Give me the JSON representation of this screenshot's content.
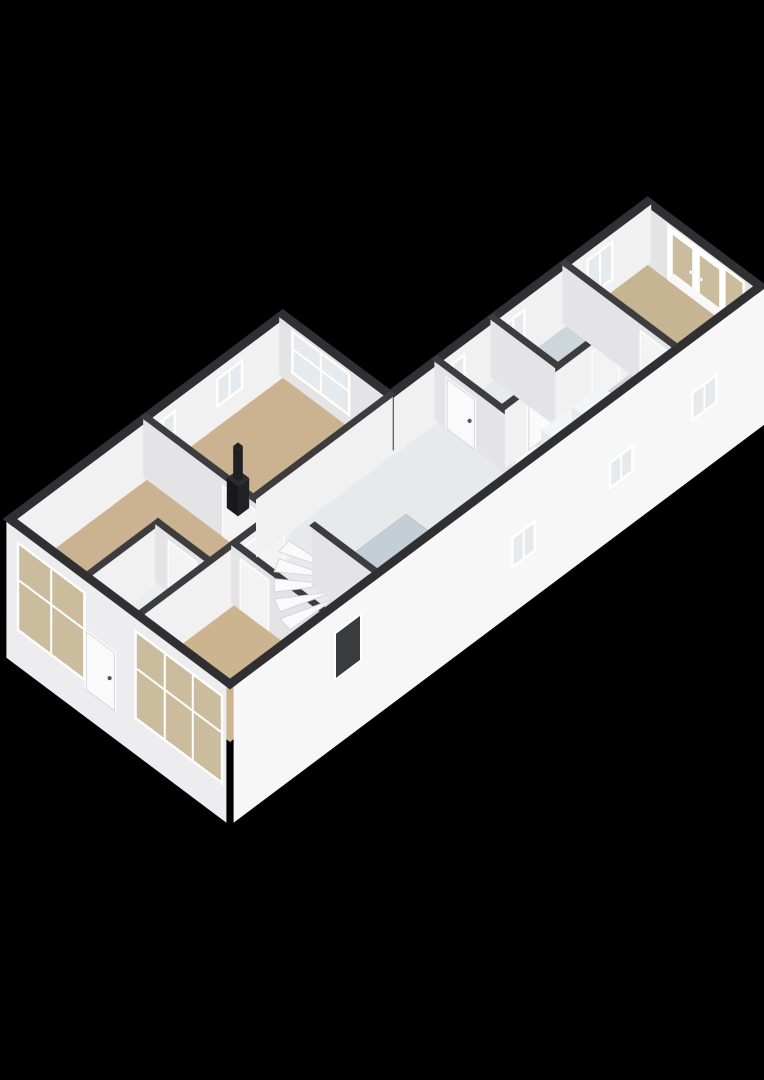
{
  "scene": {
    "width": 764,
    "height": 1080,
    "background": "#000000",
    "view": "isometric-3d-floorplan",
    "origin": [
      10,
      577
    ],
    "unit": {
      "ux": 0.8,
      "uy": -0.6,
      "vx": 0.8,
      "vy": 0.6
    },
    "wall_height": 58,
    "facade_depth": 78,
    "wall_thickness_ext": 9,
    "wall_thickness_int": 7
  },
  "palette": {
    "wall_top_ext": "#303032",
    "wall_top_int": "#3d3d3f",
    "face_se_int": "#f1f1f2",
    "face_sw_int": "#e4e4e6",
    "face_se_ext": "#f7f7f7",
    "face_sw_ext": "#ededef",
    "frame": "#ffffff",
    "glass": "#e6eaec",
    "glass_tan": "#cbbc9e",
    "gap": "#f3f3f4",
    "floor_tan": "#cbb290",
    "floor_tan2": "#ccb490",
    "floor_tan3": "#c6b493",
    "floor_blue": "#c3ced6",
    "floor_blue_light": "#cdd6db",
    "floor_white": "#e8e9ea",
    "floor_white2": "#eceded",
    "tread": "#fafafb",
    "tread_edge": "#d4d4d6",
    "door_leaf": "#fafafb",
    "door_edge": "#d8d8da",
    "door_dark": "#3a3b3d",
    "handle": "#55585b",
    "stove_top": "#2c2c2e",
    "stove_sw": "#19191b",
    "stove_se": "#222224",
    "pipe": "#202022",
    "counter_top": "#f4f4f5",
    "counter_sw": "#e2e3e5",
    "counter_se": "#ebeced",
    "cooktop": "#151618",
    "burner": "#c13336",
    "burner_core": "#7e1f22",
    "appl_top": "#f3f4f5",
    "appl_sw": "#e7e9eb",
    "appl_se": "#dfe1e4",
    "porthole_ring": "#b7bcc0",
    "porthole_glass": "#eef0f2",
    "porthole_core": "#c9cfd3",
    "threshold": "#f8f8f9"
  },
  "floors": [
    {
      "name": "floor-living-room",
      "color": "floor_tan",
      "poly": [
        [
          0,
          0
        ],
        [
          170,
          0
        ],
        [
          170,
          160
        ],
        [
          90,
          160
        ],
        [
          90,
          95
        ],
        [
          0,
          95
        ]
      ]
    },
    {
      "name": "floor-study",
      "color": "floor_tan",
      "poly": [
        [
          170,
          0
        ],
        [
          341,
          0
        ],
        [
          341,
          134
        ],
        [
          170,
          134
        ]
      ]
    },
    {
      "name": "floor-vestibule",
      "color": "floor_white2",
      "poly": [
        [
          0,
          95
        ],
        [
          90,
          95
        ],
        [
          90,
          160
        ],
        [
          0,
          160
        ]
      ]
    },
    {
      "name": "floor-bedroom-2",
      "color": "floor_tan2",
      "poly": [
        [
          0,
          160
        ],
        [
          120,
          160
        ],
        [
          120,
          275
        ],
        [
          0,
          275
        ]
      ]
    },
    {
      "name": "floor-corridor",
      "color": "floor_white",
      "poly": [
        [
          170,
          134
        ],
        [
          400,
          134
        ],
        [
          400,
          275
        ],
        [
          300,
          275
        ],
        [
          300,
          195
        ],
        [
          185,
          195
        ],
        [
          185,
          275
        ],
        [
          120,
          275
        ],
        [
          120,
          160
        ],
        [
          170,
          160
        ]
      ]
    },
    {
      "name": "floor-kitchen",
      "color": "floor_blue",
      "poly": [
        [
          185,
          195
        ],
        [
          300,
          195
        ],
        [
          300,
          275
        ],
        [
          185,
          275
        ]
      ]
    },
    {
      "name": "floor-toilet",
      "color": "floor_white",
      "poly": [
        [
          400,
          134
        ],
        [
          470,
          134
        ],
        [
          470,
          215
        ],
        [
          400,
          215
        ]
      ]
    },
    {
      "name": "floor-bathroom",
      "color": "floor_blue_light",
      "poly": [
        [
          470,
          134
        ],
        [
          560,
          134
        ],
        [
          560,
          215
        ],
        [
          470,
          215
        ]
      ]
    },
    {
      "name": "floor-laundry-hall",
      "color": "floor_blue_light",
      "poly": [
        [
          400,
          215
        ],
        [
          560,
          215
        ],
        [
          560,
          275
        ],
        [
          400,
          275
        ]
      ]
    },
    {
      "name": "floor-bedroom-3",
      "color": "floor_tan3",
      "poly": [
        [
          560,
          134
        ],
        [
          663,
          134
        ],
        [
          663,
          275
        ],
        [
          560,
          275
        ]
      ]
    }
  ],
  "parts": [
    {
      "kind": "wall",
      "name": "wall-ne-bedroom3",
      "dir": "u",
      "at": 663,
      "from": 134,
      "to": 275,
      "t": 9,
      "ext": true,
      "bottom": 0,
      "openings": [
        {
          "type": "french",
          "from": 166,
          "to": 232,
          "z0": 0,
          "z1": 53
        },
        {
          "type": "window",
          "from": 236,
          "to": 257,
          "z0": 0,
          "z1": 53,
          "glass": "glass_tan",
          "mv": 0
        }
      ]
    },
    {
      "kind": "flat",
      "name": "threshold-french-doors",
      "u0": 657,
      "v0": 164,
      "u1": 666,
      "v1": 259,
      "z": 2,
      "color": "threshold"
    },
    {
      "kind": "wall",
      "name": "wall-nw-right-facade",
      "dir": "v",
      "at": 134,
      "from": 341,
      "to": 663,
      "t": 9,
      "ext": true,
      "bottom": 0,
      "openings": [
        {
          "type": "window",
          "from": 403,
          "to": 428,
          "z0": 22,
          "z1": 46,
          "mv": 1
        },
        {
          "type": "window",
          "from": 478,
          "to": 503,
          "z0": 22,
          "z1": 46,
          "mv": 1
        },
        {
          "type": "window",
          "from": 585,
          "to": 613,
          "z0": 14,
          "z1": 48,
          "mv": 1
        }
      ]
    },
    {
      "kind": "wall",
      "name": "wall-nw-left-facade",
      "dir": "v",
      "at": 0,
      "from": 0,
      "to": 341,
      "t": 9,
      "ext": true,
      "bottom": 0,
      "openings": [
        {
          "type": "window",
          "from": 174,
          "to": 200,
          "z0": 22,
          "z1": 46,
          "mv": 1
        },
        {
          "type": "window",
          "from": 256,
          "to": 284,
          "z0": 22,
          "z1": 46,
          "mv": 1
        }
      ]
    },
    {
      "kind": "wall",
      "name": "wall-ne-study",
      "dir": "u",
      "at": 341,
      "from": 0,
      "to": 134,
      "t": 9,
      "ext": true,
      "bottom": 0,
      "openings": [
        {
          "type": "window",
          "from": 18,
          "to": 86,
          "z0": 14,
          "z1": 52,
          "mv": 1,
          "mh": 1
        }
      ]
    },
    {
      "kind": "wall",
      "name": "wall-living-study",
      "dir": "u",
      "at": 170,
      "from": 0,
      "to": 160,
      "t": 7,
      "openings": [
        {
          "type": "gap",
          "from": 100,
          "to": 148,
          "z0": 0,
          "z1": 50
        }
      ]
    },
    {
      "kind": "box",
      "name": "wood-stove",
      "u0": 193,
      "v0": 78,
      "u1": 207,
      "v1": 92,
      "z0": 0,
      "z1": 30,
      "top": "stove_top",
      "sw": "stove_sw",
      "se": "stove_se"
    },
    {
      "kind": "box",
      "name": "stove-flue-pipe",
      "u0": 197,
      "v0": 82,
      "u1": 203,
      "v1": 88,
      "z0": 30,
      "z1": 62,
      "top": "pipe",
      "sw": "pipe",
      "se": "pipe"
    },
    {
      "kind": "wall",
      "name": "wall-living-vestibule",
      "dir": "v",
      "at": 95,
      "from": 0,
      "to": 90,
      "t": 7,
      "openings": []
    },
    {
      "kind": "wall",
      "name": "wall-vestibule-east",
      "dir": "u",
      "at": 90,
      "from": 95,
      "to": 160,
      "t": 7,
      "openings": [
        {
          "type": "gap",
          "from": 112,
          "to": 146,
          "z0": 0,
          "z1": 50
        }
      ]
    },
    {
      "kind": "flat",
      "name": "threshold-vestibule",
      "u0": 86,
      "v0": 112,
      "u1": 94,
      "v1": 146,
      "z": 2.5,
      "color": "threshold"
    },
    {
      "kind": "wall",
      "name": "wall-living-south",
      "dir": "v",
      "at": 160,
      "from": 0,
      "to": 185,
      "t": 7,
      "openings": [
        {
          "type": "gap",
          "from": 128,
          "to": 178,
          "z0": 0,
          "z1": 50
        }
      ]
    },
    {
      "kind": "wall",
      "name": "wall-bedroom2-east",
      "dir": "u",
      "at": 120,
      "from": 160,
      "to": 275,
      "t": 7,
      "openings": [
        {
          "type": "gap",
          "from": 172,
          "to": 206,
          "z0": 0,
          "z1": 50
        }
      ]
    },
    {
      "kind": "wall",
      "name": "wall-study-south",
      "dir": "v",
      "at": 134,
      "from": 170,
      "to": 341,
      "t": 7,
      "openings": []
    },
    {
      "kind": "treads",
      "name": "winder-staircase",
      "pivot": [
        180,
        226
      ],
      "r": 54,
      "a0": 182,
      "a1": 266,
      "steps": 5,
      "z0": 6,
      "dz": 7
    },
    {
      "kind": "wall",
      "name": "wall-stairs-east",
      "dir": "u",
      "at": 185,
      "from": 196,
      "to": 275,
      "t": 7,
      "openings": []
    },
    {
      "kind": "box",
      "name": "kitchen-counter",
      "u0": 243,
      "v0": 255,
      "u1": 291,
      "v1": 273,
      "z0": 0,
      "z1": 28,
      "top": "counter_top",
      "sw": "counter_sw",
      "se": "counter_se"
    },
    {
      "kind": "flat",
      "name": "cooktop",
      "u0": 246,
      "v0": 257,
      "u1": 288,
      "v1": 271,
      "z": 28.4,
      "color": "cooktop"
    },
    {
      "kind": "burners",
      "name": "cooktop-burners",
      "cu": [
        256,
        276
      ],
      "cv": [
        260.5,
        267.5
      ],
      "z": 29,
      "r": 4.2
    },
    {
      "kind": "wall",
      "name": "wall-corridor-east",
      "dir": "u",
      "at": 400,
      "from": 134,
      "to": 275,
      "t": 7,
      "openings": [
        {
          "type": "door",
          "from": 150,
          "to": 184,
          "z0": 0,
          "z1": 50
        },
        {
          "type": "door",
          "from": 234,
          "to": 266,
          "z0": 0,
          "z1": 50
        }
      ]
    },
    {
      "kind": "wall",
      "name": "wall-toilet-bath-south",
      "dir": "v",
      "at": 215,
      "from": 400,
      "to": 560,
      "t": 7,
      "openings": [
        {
          "type": "door",
          "from": 430,
          "to": 460,
          "z0": 0,
          "z1": 50
        },
        {
          "type": "gap",
          "from": 510,
          "to": 542,
          "z0": 0,
          "z1": 50
        }
      ]
    },
    {
      "kind": "wall",
      "name": "wall-toilet-bathroom",
      "dir": "u",
      "at": 470,
      "from": 134,
      "to": 215,
      "t": 7,
      "openings": []
    },
    {
      "kind": "wall",
      "name": "wall-bath-bedroom3",
      "dir": "u",
      "at": 560,
      "from": 134,
      "to": 275,
      "t": 7,
      "openings": [
        {
          "type": "gap",
          "from": 232,
          "to": 268,
          "z0": 0,
          "z1": 50
        }
      ]
    },
    {
      "kind": "flat",
      "name": "threshold-bedroom3",
      "u0": 556,
      "v0": 232,
      "u1": 564,
      "v1": 268,
      "z": 2.5,
      "color": "threshold"
    },
    {
      "kind": "box",
      "name": "washing-machine",
      "u0": 428,
      "v0": 236,
      "u1": 464,
      "v1": 272,
      "z0": 0,
      "z1": 32,
      "top": "appl_top",
      "sw": "appl_sw",
      "se": "appl_se"
    },
    {
      "kind": "porthole",
      "name": "washing-machine-door",
      "u": 428,
      "v": 254,
      "z": 16,
      "r": 7.5
    },
    {
      "kind": "box",
      "name": "dryer",
      "u0": 466,
      "v0": 236,
      "u1": 502,
      "v1": 272,
      "z0": 0,
      "z1": 32,
      "top": "appl_top",
      "sw": "appl_sw",
      "se": "appl_se"
    },
    {
      "kind": "wall",
      "name": "wall-se-facade",
      "dir": "v",
      "at": 275,
      "from": 0,
      "to": 663,
      "t": 9,
      "ext": true,
      "facade": true,
      "openings": [
        {
          "type": "door_dark",
          "from": 128,
          "to": 158,
          "z0": -10,
          "z1": 34
        },
        {
          "type": "window",
          "from": 350,
          "to": 375,
          "z0": -30,
          "z1": -4,
          "mv": 1
        },
        {
          "type": "window",
          "from": 472,
          "to": 497,
          "z0": -24,
          "z1": -2,
          "mv": 1
        },
        {
          "type": "window",
          "from": 575,
          "to": 602,
          "z0": -18,
          "z1": 6,
          "mv": 1
        }
      ]
    },
    {
      "kind": "wall",
      "name": "wall-sw-facade",
      "dir": "u",
      "at": 0,
      "from": 0,
      "to": 275,
      "t": 9,
      "ext": true,
      "facade": true,
      "openings": [
        {
          "type": "window",
          "from": 16,
          "to": 96,
          "z0": -40,
          "z1": 44,
          "glass": "glass_tan",
          "mv": 1,
          "mh": 1
        },
        {
          "type": "door",
          "from": 100,
          "to": 135,
          "z0": -50,
          "z1": 8
        },
        {
          "type": "window",
          "from": 163,
          "to": 268,
          "z0": -40,
          "z1": 44,
          "glass": "glass_tan",
          "mv": 2,
          "mh": 1
        }
      ]
    }
  ]
}
